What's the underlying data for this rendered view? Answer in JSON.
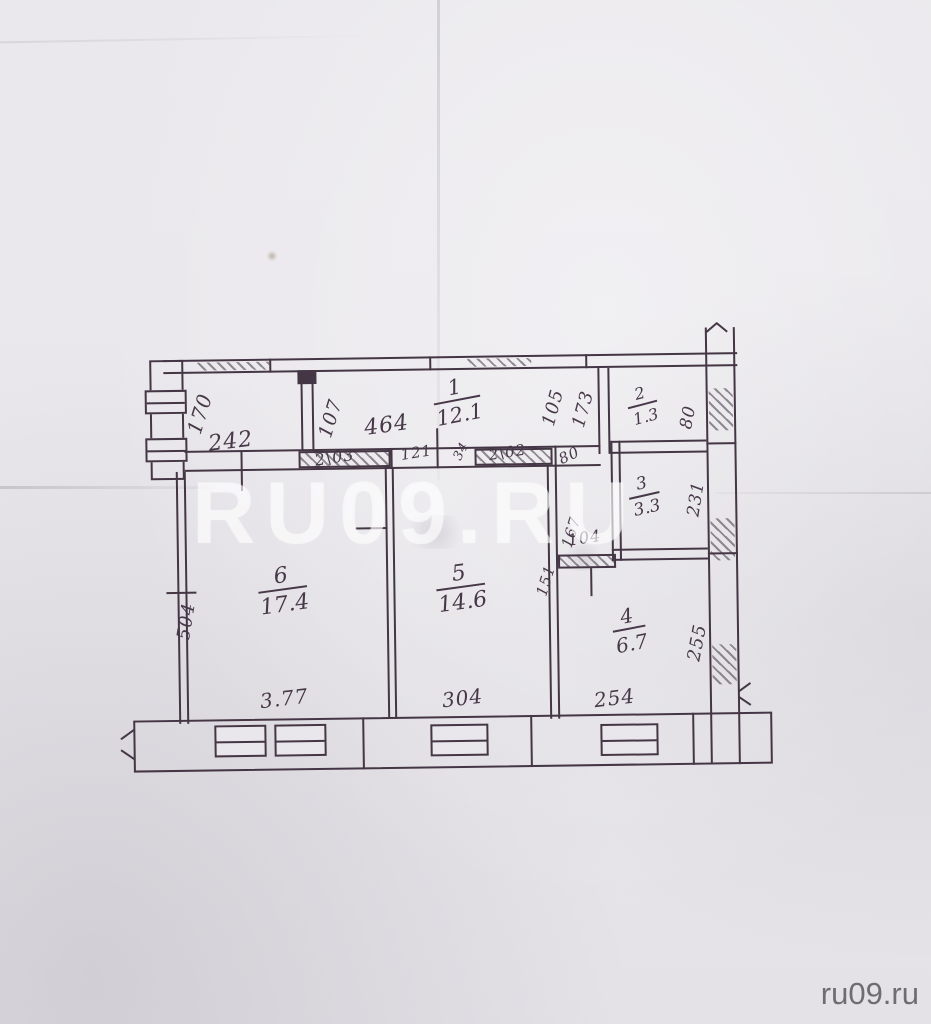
{
  "watermark": {
    "large": "RU09.RU",
    "corner": "ru09.ru"
  },
  "rooms": [
    {
      "num": "1",
      "area": "12.1"
    },
    {
      "num": "2",
      "area": "1.3"
    },
    {
      "num": "3",
      "area": "3.3"
    },
    {
      "num": "4",
      "area": "6.7"
    },
    {
      "num": "5",
      "area": "14.6"
    },
    {
      "num": "6",
      "area": "17.4"
    }
  ],
  "dims": {
    "v170": "170",
    "h242": "242",
    "v107": "107",
    "h464": "464",
    "closet_a": "2\\03",
    "h121": "121",
    "d34": "34",
    "closet_b": "2\\02",
    "opening80": "80",
    "v105": "105",
    "v173": "173",
    "v80_room2": "80",
    "v231": "231",
    "h104": "104",
    "v167": "167",
    "v151": "151",
    "v504": "504",
    "h377": "3.77",
    "h304": "304",
    "h254": "254",
    "v255": "255"
  }
}
